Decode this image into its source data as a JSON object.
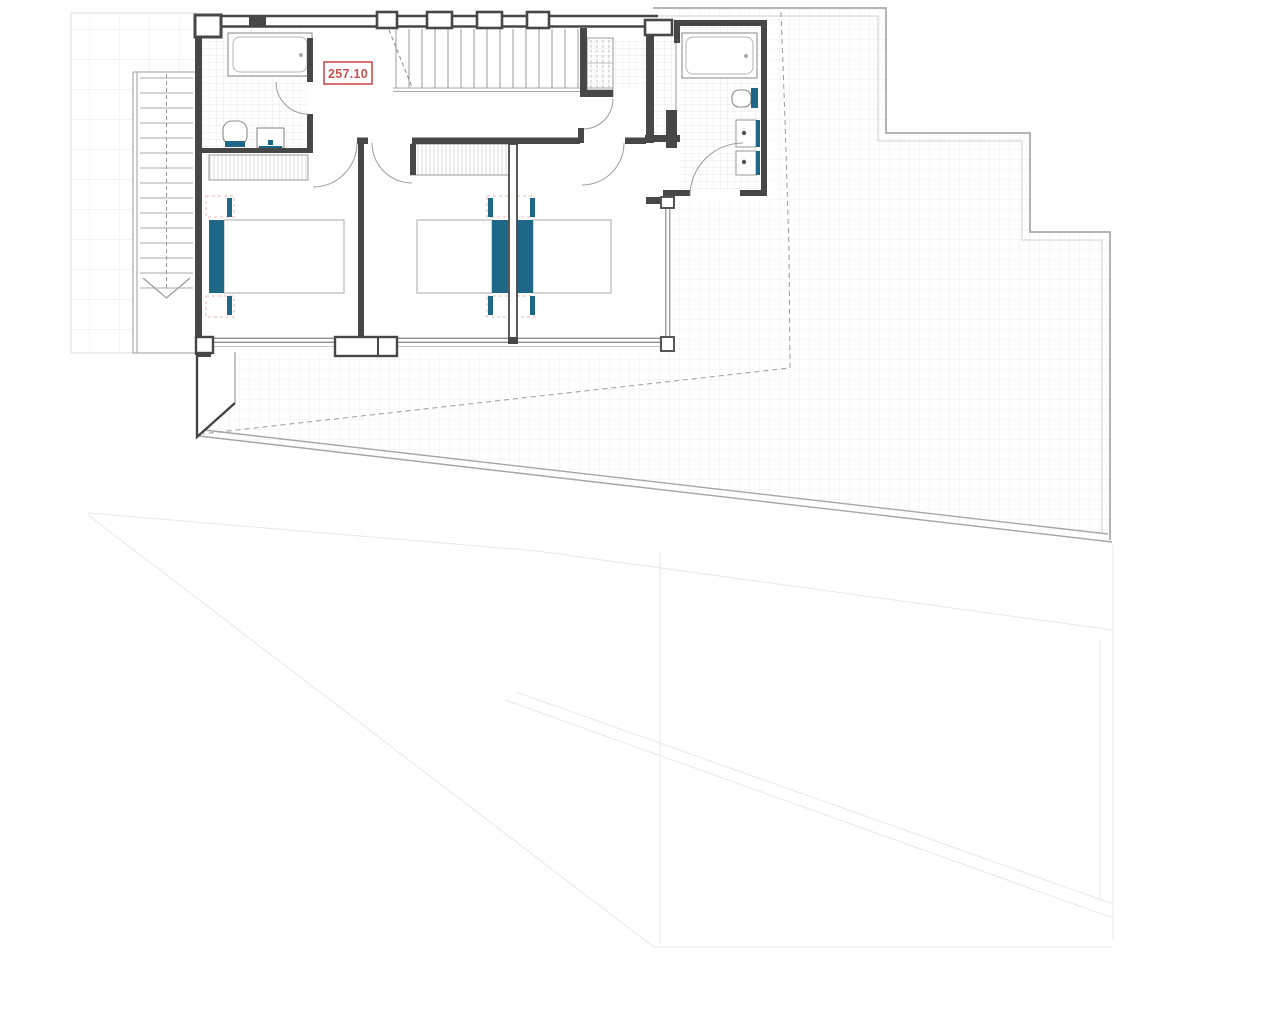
{
  "drawing": {
    "area_label": "257.10",
    "colors": {
      "wall": "#474747",
      "wall_light": "#8f8f8f",
      "accent_teal": "#1f6787",
      "label_red": "#c9504e",
      "grid_line": "#eaeaea",
      "tile_line": "#e3e3e3",
      "boundary_gray": "#ababab",
      "faint_gray": "#e8e8e8",
      "pink_dash": "#eeb7b7"
    },
    "counts": {
      "bedrooms": 3,
      "bathrooms": 2,
      "beds": 3,
      "staircases": 2
    }
  }
}
